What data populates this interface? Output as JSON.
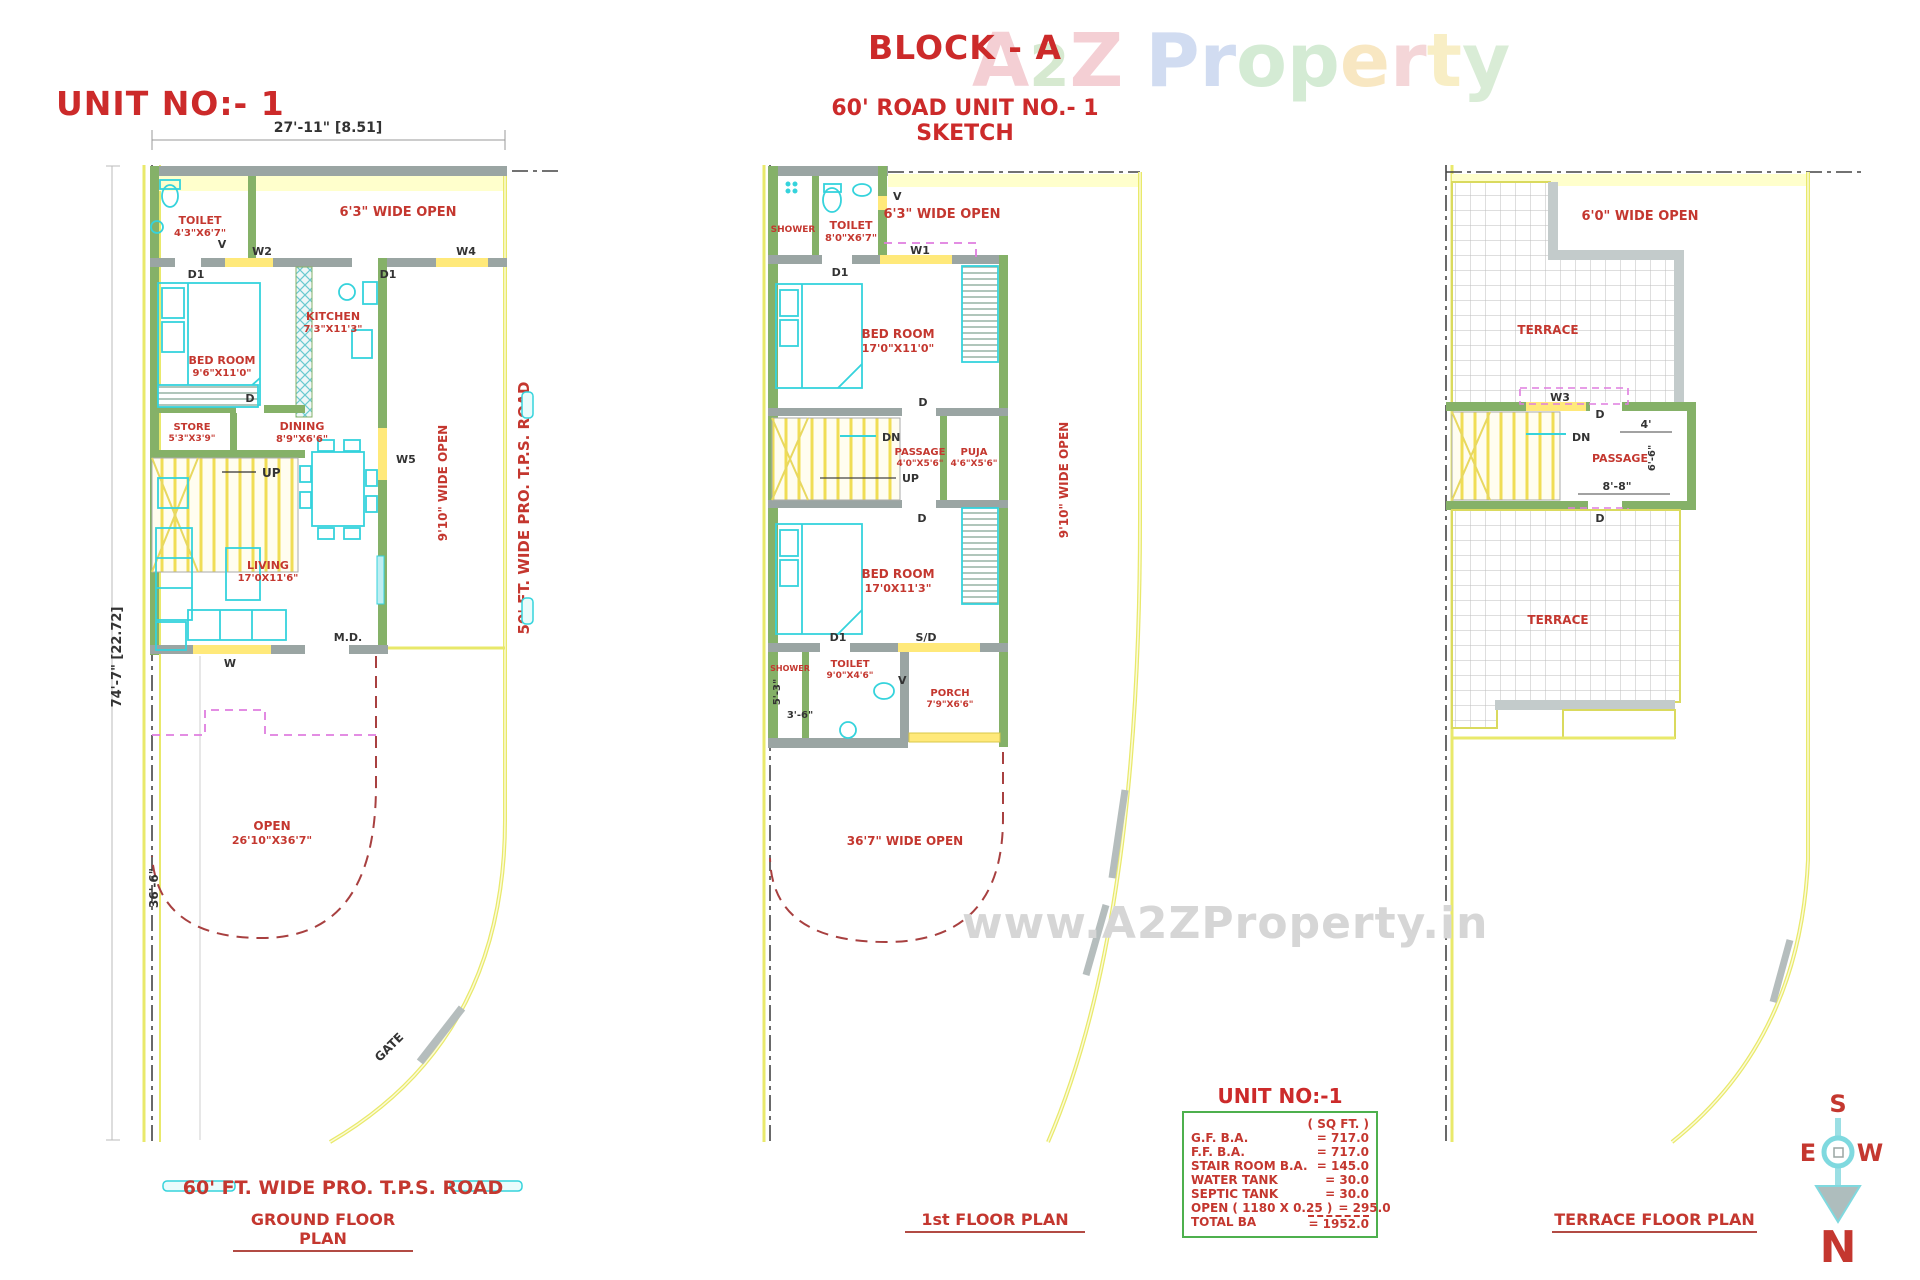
{
  "header": {
    "unit_title": "UNIT NO:- 1",
    "block_title": "BLOCK - A",
    "block_subtitle": "60' ROAD UNIT NO.- 1 SKETCH"
  },
  "watermark": {
    "top_letters": [
      "A",
      "2",
      "Z",
      "P",
      "r",
      "o",
      "p",
      "e",
      "r",
      "t",
      "y"
    ],
    "center_text": "www.A2ZProperty.in"
  },
  "compass": {
    "north": "N",
    "south": "S",
    "east": "E",
    "west": "W"
  },
  "area_table": {
    "title": "UNIT NO:-1",
    "unit_header": "( SQ FT. )",
    "rows": [
      {
        "label": "G.F. B.A.",
        "value": "= 717.0"
      },
      {
        "label": "F.F. B.A.",
        "value": "= 717.0"
      },
      {
        "label": "STAIR ROOM B.A.",
        "value": "= 145.0"
      },
      {
        "label": "WATER TANK",
        "value": "=  30.0"
      },
      {
        "label": "SEPTIC TANK",
        "value": "=  30.0"
      },
      {
        "label": "OPEN ( 1180 X 0.25 )",
        "value": "= 295.0"
      }
    ],
    "total_label": "TOTAL BA",
    "total_value": "= 1952.0"
  },
  "ground_floor": {
    "plan_title": "GROUND FLOOR PLAN",
    "road_bottom": "60' FT. WIDE  PRO.  T.P.S.  ROAD",
    "road_side": "50' FT. WIDE PRO.  T.P.S.  ROAD",
    "dim_width": "27'-11\" [8.51]",
    "dim_height": "74'-7\" [22.72]",
    "dim_open": "36'-6\"",
    "wide_open_top": "6'3\" WIDE OPEN",
    "wide_open_side": "9'10\" WIDE OPEN",
    "open_name": "OPEN",
    "open_size": "26'10\"X36'7\"",
    "gate": "GATE",
    "rooms": {
      "toilet": {
        "name": "TOILET",
        "size": "4'3\"X6'7\""
      },
      "kitchen": {
        "name": "KITCHEN",
        "size": "7'3\"X11'3\""
      },
      "bedroom": {
        "name": "BED ROOM",
        "size": "9'6\"X11'0\""
      },
      "store": {
        "name": "STORE",
        "size": "5'3\"X3'9\""
      },
      "dining": {
        "name": "DINING",
        "size": "8'9\"X6'6\""
      },
      "living": {
        "name": "LIVING",
        "size": "17'0X11'6\""
      }
    },
    "tags": {
      "v": "V",
      "w2": "W2",
      "w4": "W4",
      "d1_toilet": "D1",
      "d1_kitchen": "D1",
      "d": "D",
      "up": "UP",
      "w5": "W5",
      "md": "M.D.",
      "w": "W"
    }
  },
  "first_floor": {
    "plan_title": "1st FLOOR PLAN",
    "wide_open_top": "6'3\" WIDE OPEN",
    "wide_open_side": "9'10\" WIDE OPEN",
    "wide_open_bottom": "36'7\" WIDE OPEN",
    "dim_a": "5'-3\"",
    "dim_b": "3'-6\"",
    "rooms": {
      "shower_top": {
        "name": "SHOWER"
      },
      "toilet_top": {
        "name": "TOILET",
        "size": "8'0\"X6'7\""
      },
      "bedroom_top": {
        "name": "BED ROOM",
        "size": "17'0\"X11'0\""
      },
      "passage": {
        "name": "PASSAGE",
        "size": "4'0\"X5'6\""
      },
      "puja": {
        "name": "PUJA",
        "size": "4'6\"X5'6\""
      },
      "bedroom_bottom": {
        "name": "BED ROOM",
        "size": "17'0X11'3\""
      },
      "shower_bottom": {
        "name": "SHOWER"
      },
      "toilet_bottom": {
        "name": "TOILET",
        "size": "9'0\"X4'6\""
      },
      "porch": {
        "name": "PORCH",
        "size": "7'9\"X6'6\""
      }
    },
    "tags": {
      "v_top": "V",
      "w1": "W1",
      "d1_top": "D1",
      "d_top": "D",
      "dn": "DN",
      "up": "UP",
      "d_mid": "D",
      "d1_bottom": "D1",
      "sd": "S/D",
      "v_bottom": "V"
    }
  },
  "terrace_floor": {
    "plan_title": "TERRACE FLOOR PLAN",
    "wide_open_top": "6'0\" WIDE OPEN",
    "terrace_upper": "TERRACE",
    "terrace_lower": "TERRACE",
    "passage": "PASSAGE",
    "dim_a": "4'",
    "dim_b": "6'-6\"",
    "dim_c": "8'-8\"",
    "tags": {
      "w3": "W3",
      "d_top": "D",
      "dn": "DN",
      "d_bottom": "D"
    }
  },
  "palette": {
    "label_red": "#c4372f",
    "wall_green": "#85b168",
    "wall_gray": "#9aa5a3",
    "fixture_cyan": "#35d3dc",
    "boundary_yellow": "#e9e96b",
    "dashed_magenta": "#df7ddf",
    "dashed_dark_red": "#a84040"
  }
}
